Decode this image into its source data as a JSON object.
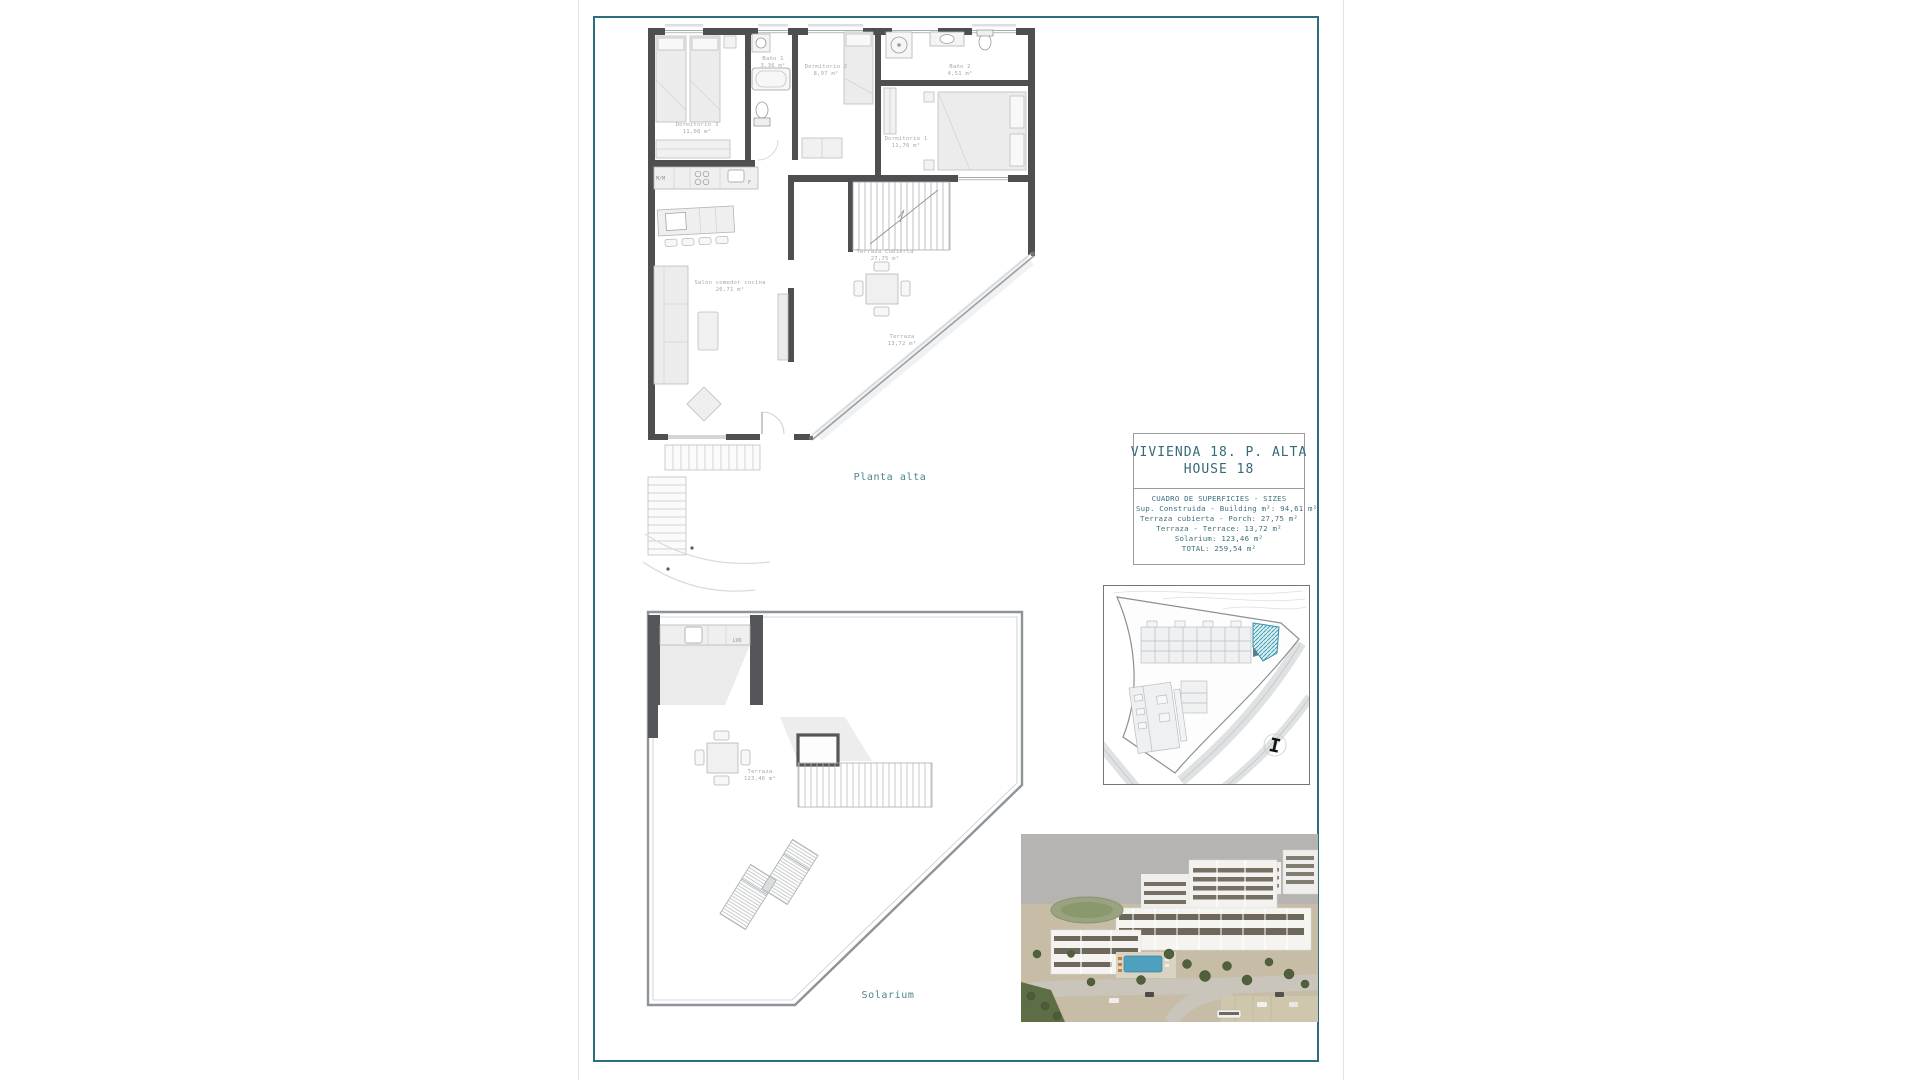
{
  "colors": {
    "frame_teal": "#2b6e7c",
    "title_teal": "#336b78",
    "floor_label_teal": "#4e8490",
    "site_highlight_teal": "#3f9cb1"
  },
  "upper_plan": {
    "floor_label": "Planta alta",
    "rooms": {
      "dorm3": {
        "name": "Dormitorio 3",
        "area": "11,08 m²"
      },
      "bath1": {
        "name": "Baño 1",
        "area": "3,36 m²"
      },
      "dorm2": {
        "name": "Dormitorio 2",
        "area": "8,97 m²"
      },
      "bath2": {
        "name": "Baño 2",
        "area": "4,51 m²"
      },
      "dorm1": {
        "name": "Dormitorio 1",
        "area": "11,76 m²"
      },
      "salon": {
        "name": "Salón comedor cocina",
        "area": "26,71 m²"
      },
      "terraza_cubierta": {
        "name": "Terraza Cubierta",
        "area": "27,75 m²"
      },
      "terraza": {
        "name": "Terraza",
        "area": "13,72 m²"
      }
    },
    "appliances": {
      "mm": "M/M",
      "f": "F"
    }
  },
  "lower_plan": {
    "floor_label": "Solarium",
    "rooms": {
      "terraza": {
        "name": "Terraza",
        "area": "123,46 m²"
      }
    },
    "appliances": {
      "lvd": "LVD"
    }
  },
  "title_block": {
    "line1": "VIVIENDA 18. P. ALTA",
    "line2": "HOUSE 18",
    "table_title": "CUADRO DE SUPERFICIES  - SIZES",
    "rows": [
      "Sup. Construida  - Building m²: 94,61 m²",
      "Terraza cubierta  - Porch: 27,75 m²",
      "Terraza - Terrace: 13,72 m²",
      "Solarium:  123,46 m²",
      "TOTAL:  259,54 m²"
    ]
  },
  "site_plan": {
    "compass_mark": "I"
  }
}
